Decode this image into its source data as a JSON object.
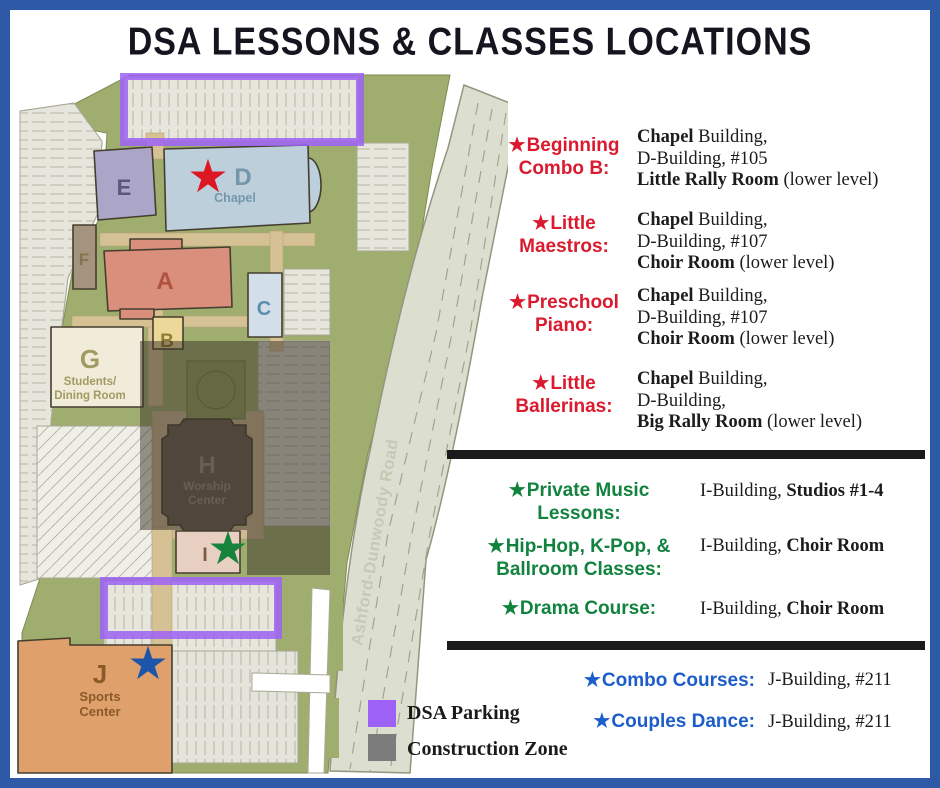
{
  "title": "DSA LESSONS & CLASSES LOCATIONS",
  "glyphs": {
    "star": "★"
  },
  "colors": {
    "border_blue": "#2e59a7",
    "red_accent": "#da1a2e",
    "green_accent": "#12823f",
    "blue_accent": "#1c5dc9",
    "parking_purple": "#9e61f6",
    "construction_gray": "#7c7c7c"
  },
  "map": {
    "road_label": "Ashford-Dunwoody Road",
    "buildings": {
      "E": {
        "label": "E"
      },
      "D": {
        "label": "D",
        "sub": "Chapel"
      },
      "F": {
        "label": "F"
      },
      "A": {
        "label": "A"
      },
      "C": {
        "label": "C"
      },
      "B": {
        "label": "B"
      },
      "G": {
        "label": "G",
        "sub1": "Students/",
        "sub2": "Dining Room"
      },
      "H": {
        "label": "H",
        "sub1": "Worship",
        "sub2": "Center"
      },
      "I": {
        "label": "I"
      },
      "J": {
        "label": "J",
        "sub1": "Sports",
        "sub2": "Center"
      }
    }
  },
  "classes": {
    "red": [
      {
        "name1": "Beginning",
        "name2": "Combo B:",
        "location": "**Chapel** Building,\nD-Building, #105\n**Little Rally Room** (lower level)"
      },
      {
        "name1": "Little",
        "name2": "Maestros:",
        "location": "**Chapel** Building,\nD-Building, #107\n**Choir Room** (lower level)"
      },
      {
        "name1": "Preschool",
        "name2": "Piano:",
        "location": "**Chapel** Building,\nD-Building, #107\n**Choir Room** (lower level)"
      },
      {
        "name1": "Little",
        "name2": "Ballerinas:",
        "location": "**Chapel** Building,\nD-Building,\n**Big Rally Room** (lower level)"
      }
    ],
    "green": [
      {
        "name1": "Private Music",
        "name2": "Lessons:",
        "location": "I-Building, **Studios #1-4**"
      },
      {
        "name1": "Hip-Hop, K-Pop, &",
        "name2": "Ballroom Classes:",
        "location": "I-Building, **Choir Room**"
      },
      {
        "name1": "Drama Course:",
        "name2": "",
        "location": "I-Building, **Choir Room**"
      }
    ],
    "blue": [
      {
        "name": "Combo Courses:",
        "location": "J-Building, #211"
      },
      {
        "name": "Couples Dance:",
        "location": "J-Building, #211"
      }
    ]
  },
  "legend": {
    "parking_label": "DSA Parking",
    "construction_label": "Construction Zone"
  }
}
